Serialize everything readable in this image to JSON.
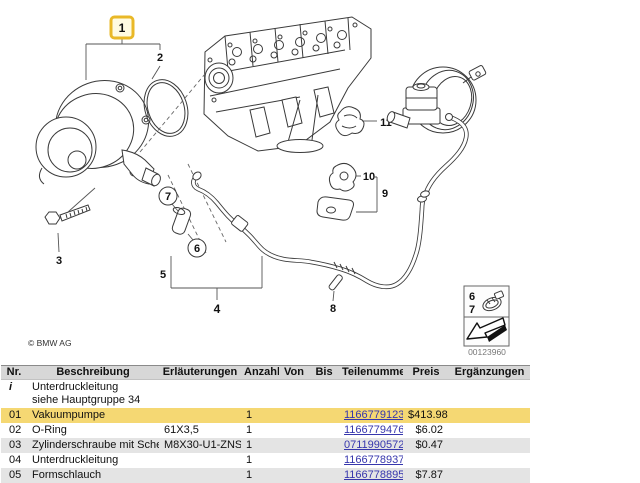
{
  "diagram": {
    "callouts": [
      {
        "label": "1",
        "highlighted": true
      },
      {
        "label": "2"
      },
      {
        "label": "3"
      },
      {
        "label": "4"
      },
      {
        "label": "5"
      },
      {
        "label": "6"
      },
      {
        "label": "7"
      },
      {
        "label": "8"
      },
      {
        "label": "9"
      },
      {
        "label": "10"
      },
      {
        "label": "11"
      }
    ],
    "legend": {
      "top_label": "6",
      "bottom_label": "7"
    },
    "copyright": "© BMW AG",
    "image_number": "00123960",
    "highlight_color": "#e9b827"
  },
  "table": {
    "headers": [
      "Nr.",
      "Beschreibung",
      "Erläuterungen",
      "Anzahl",
      "Von",
      "Bis",
      "Teilenummer",
      "Preis",
      "Ergänzungen"
    ],
    "rows": [
      {
        "nr": "i",
        "beschreibung": "Unterdruckleitung",
        "note": "siehe Hauptgruppe 34",
        "erlaeuterungen": "",
        "anzahl": "",
        "von": "",
        "bis": "",
        "teilenummer": "",
        "preis": "",
        "ergaenzungen": "",
        "type": "info"
      },
      {
        "nr": "01",
        "beschreibung": "Vakuumpumpe",
        "note": "",
        "erlaeuterungen": "",
        "anzahl": "1",
        "von": "",
        "bis": "",
        "teilenummer": "11667791232",
        "preis": "$413.98",
        "ergaenzungen": "",
        "type": "highlight"
      },
      {
        "nr": "02",
        "beschreibung": "O-Ring",
        "note": "",
        "erlaeuterungen": "61X3,5",
        "anzahl": "1",
        "von": "",
        "bis": "",
        "teilenummer": "11667794767",
        "preis": "$6.02",
        "ergaenzungen": "",
        "type": "normal"
      },
      {
        "nr": "03",
        "beschreibung": "Zylinderschraube mit Scheibe",
        "note": "",
        "erlaeuterungen": "M8X30-U1-ZNS3",
        "anzahl": "1",
        "von": "",
        "bis": "",
        "teilenummer": "07119905720",
        "preis": "$0.47",
        "ergaenzungen": "",
        "type": "shade"
      },
      {
        "nr": "04",
        "beschreibung": "Unterdruckleitung",
        "note": "",
        "erlaeuterungen": "",
        "anzahl": "1",
        "von": "",
        "bis": "",
        "teilenummer": "11667789373",
        "preis": "",
        "ergaenzungen": "",
        "type": "normal"
      },
      {
        "nr": "05",
        "beschreibung": "Formschlauch",
        "note": "",
        "erlaeuterungen": "",
        "anzahl": "1",
        "von": "",
        "bis": "",
        "teilenummer": "11667788959",
        "preis": "$7.87",
        "ergaenzungen": "",
        "type": "shade"
      }
    ]
  }
}
